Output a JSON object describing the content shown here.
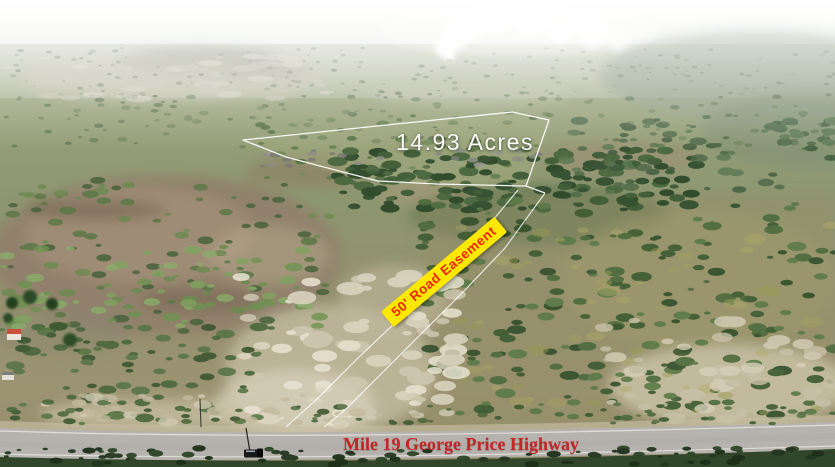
{
  "photo": {
    "description": "aerial drone photo of rural land parcel for sale",
    "annotations": {
      "acreage_label": "14.93 Acres",
      "easement_label": "50' Road Easement",
      "highway_label": "Mile 19 George Price Highway"
    },
    "colors": {
      "acreage_text": "#fdfdfa",
      "easement_text": "#ea2800",
      "easement_background": "#ffe800",
      "highway_text": "#c12525",
      "boundary_lines": "#ffffff"
    }
  }
}
